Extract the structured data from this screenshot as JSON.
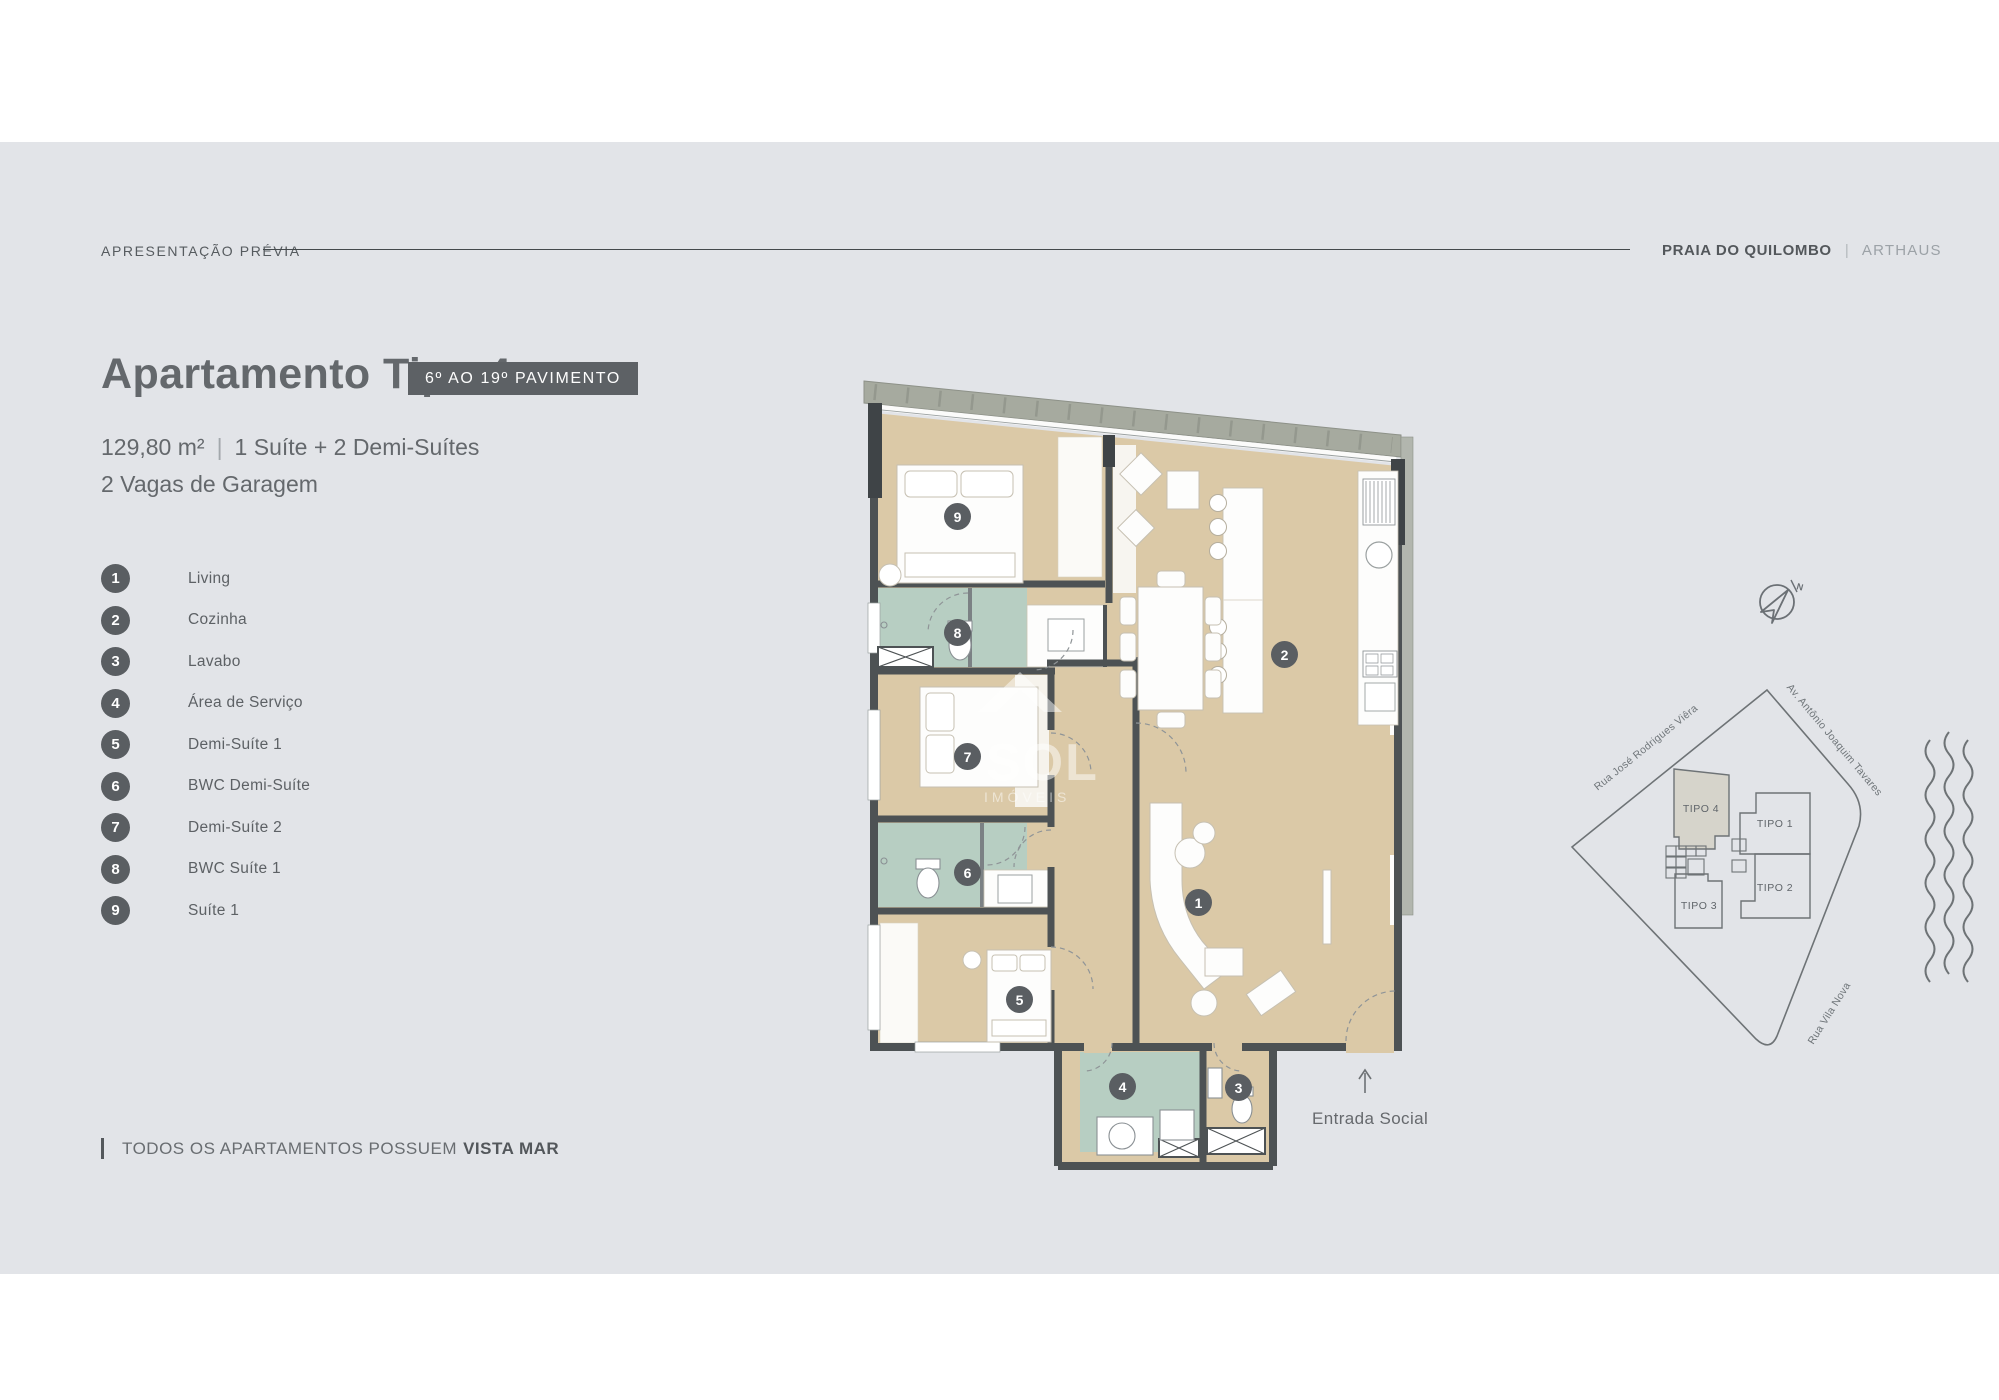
{
  "header": {
    "eyebrow": "APRESENTAÇÃO PRÉVIA",
    "project": "PRAIA DO QUILOMBO",
    "separator": "|",
    "brand": "ARTHAUS"
  },
  "hero": {
    "title": "Apartamento Tipo 4",
    "badge": "6º AO 19º PAVIMENTO",
    "area": "129,80 m²",
    "sep": "|",
    "program": "1 Suíte + 2 Demi-Suítes",
    "parking": "2 Vagas de Garagem"
  },
  "legend": [
    {
      "num": "1",
      "label": "Living"
    },
    {
      "num": "2",
      "label": "Cozinha"
    },
    {
      "num": "3",
      "label": "Lavabo"
    },
    {
      "num": "4",
      "label": "Área de Serviço"
    },
    {
      "num": "5",
      "label": "Demi-Suíte 1"
    },
    {
      "num": "6",
      "label": "BWC Demi-Suíte"
    },
    {
      "num": "7",
      "label": "Demi-Suíte 2"
    },
    {
      "num": "8",
      "label": "BWC Suíte 1"
    },
    {
      "num": "9",
      "label": "Suíte 1"
    }
  ],
  "footnote": {
    "text": "TODOS OS APARTAMENTOS POSSUEM",
    "highlight": "VISTA MAR"
  },
  "plan": {
    "entrance_label": "Entrada Social",
    "watermark_line1": "SOL",
    "watermark_line2": "IMÓVEIS"
  },
  "sitemap": {
    "north": "N",
    "streets": {
      "northwest": "Rua José Rodrigues Viêra",
      "northeast": "Av. Antônio Joaquim Tavares",
      "south": "Rua Vila Nova"
    },
    "buildings": {
      "tipo4": "TIPO 4",
      "tipo1": "TIPO 1",
      "tipo2": "TIPO 2",
      "tipo3": "TIPO 3"
    }
  },
  "colors": {
    "panel": "#e2e4e8",
    "accent_dark": "#5a5e62",
    "wood": "#dbc9a7",
    "bath_green": "#b7cec2",
    "wall": "#4d5254"
  }
}
